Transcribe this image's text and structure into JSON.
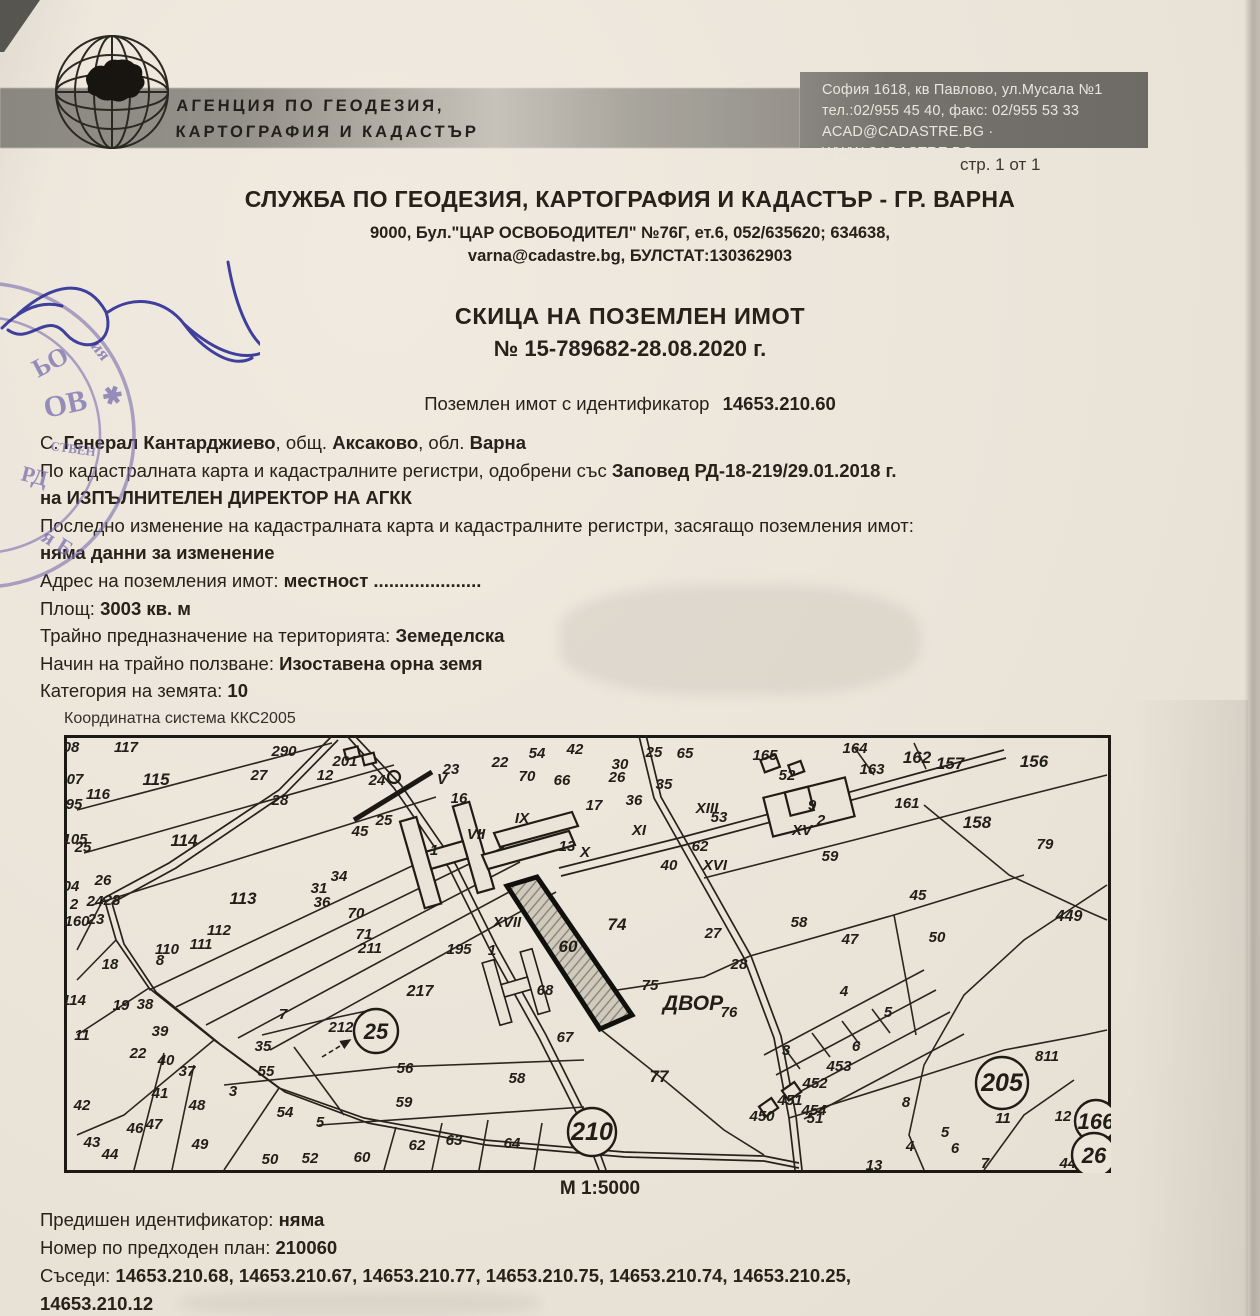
{
  "page": {
    "marker": "стр. 1 от 1"
  },
  "agency": {
    "logo_icon": "globe-bulgaria-icon",
    "name_line1": "АГЕНЦИЯ ПО ГЕОДЕЗИЯ,",
    "name_line2": "КАРТОГРАФИЯ И КАДАСТЪР",
    "address_line1": "София 1618, кв Павлово, ул.Мусала №1",
    "address_line2": "тел.:02/955 45 40, факс: 02/955 53 33",
    "address_line3": "ACAD@CADASTRE.BG · WWW.CADASTRE.BG"
  },
  "office": {
    "title": "СЛУЖБА ПО ГЕОДЕЗИЯ, КАРТОГРАФИЯ И КАДАСТЪР - ГР. ВАРНА",
    "address_line1": "9000, Бул.\"ЦАР ОСВОБОДИТЕЛ\" №76Г, ет.6, 052/635620; 634638,",
    "address_line2": "varna@cadastre.bg, БУЛСТАТ:130362903"
  },
  "document": {
    "title": "СКИЦА НА ПОЗЕМЛЕН ИМОТ",
    "number": "№ 15-789682-28.08.2020 г.",
    "identifier_label": "Поземлен имот с  идентификатор",
    "identifier": "14653.210.60"
  },
  "details": {
    "lines": [
      [
        [
          "С. ",
          0
        ],
        [
          "Генерал Кантарджиево",
          1
        ],
        [
          ", общ. ",
          0
        ],
        [
          "Аксаково",
          1
        ],
        [
          ", обл. ",
          0
        ],
        [
          "Варна",
          1
        ]
      ],
      [
        [
          "По кадастралната карта и кадастралните регистри, одобрени със ",
          0
        ],
        [
          "Заповед РД-18-219/29.01.2018 г.",
          1
        ]
      ],
      [
        [
          "на ИЗПЪЛНИТЕЛЕН ДИРЕКТОР НА АГКК",
          1
        ]
      ],
      [
        [
          "Последно изменение на кадастралната карта и кадастралните регистри, засягащо поземления имот:",
          0
        ]
      ],
      [
        [
          "няма данни за изменение",
          1
        ]
      ],
      [
        [
          "Адрес на поземления имот: ",
          0
        ],
        [
          "местност .....................",
          1
        ]
      ],
      [
        [
          "Площ: ",
          0
        ],
        [
          "3003 кв. м",
          1
        ]
      ],
      [
        [
          "Трайно предназначение на територията: ",
          0
        ],
        [
          "Земеделска",
          1
        ]
      ],
      [
        [
          "Начин на трайно ползване: ",
          0
        ],
        [
          "Изоставена орна земя",
          1
        ]
      ],
      [
        [
          "Категория на земята: ",
          0
        ],
        [
          "10",
          1
        ]
      ]
    ]
  },
  "map": {
    "caption": "Координатна система ККС2005",
    "scale": "М 1:5000",
    "highlight": {
      "label": "60",
      "x": 504,
      "y": 212,
      "size": 17
    },
    "zone_label": {
      "text": "ДВОР",
      "x": 629,
      "y": 268,
      "size": 21
    },
    "circles": [
      {
        "label": "25",
        "x": 312,
        "y": 296,
        "r": 22
      },
      {
        "label": "210",
        "x": 528,
        "y": 397,
        "r": 24
      },
      {
        "label": "205",
        "x": 938,
        "y": 348,
        "r": 26
      },
      {
        "label": "166",
        "x": 1032,
        "y": 386,
        "r": 21
      },
      {
        "label": "26",
        "x": 1030,
        "y": 420,
        "r": 22
      }
    ],
    "labels": [
      [
        "08",
        7,
        12
      ],
      [
        "117",
        62,
        12
      ],
      [
        "07",
        11,
        44
      ],
      [
        "115",
        92,
        45,
        17
      ],
      [
        "116",
        34,
        59
      ],
      [
        "95",
        10,
        69
      ],
      [
        "105",
        11,
        104
      ],
      [
        "25",
        19,
        112
      ],
      [
        "114",
        120,
        106,
        17
      ],
      [
        "26",
        39,
        145
      ],
      [
        "04",
        7,
        151
      ],
      [
        "24",
        31,
        166
      ],
      [
        "28",
        48,
        165
      ],
      [
        "2",
        10,
        169
      ],
      [
        "160",
        13,
        186
      ],
      [
        "23",
        32,
        184
      ],
      [
        "113",
        179,
        164,
        17
      ],
      [
        "112",
        155,
        195
      ],
      [
        "111",
        137,
        209
      ],
      [
        "110",
        103,
        214
      ],
      [
        "18",
        46,
        229
      ],
      [
        "114",
        10,
        265
      ],
      [
        "19",
        57,
        270
      ],
      [
        "38",
        81,
        269
      ],
      [
        "39",
        96,
        296
      ],
      [
        "11",
        18,
        300
      ],
      [
        "22",
        74,
        318
      ],
      [
        "40",
        102,
        325
      ],
      [
        "37",
        123,
        336
      ],
      [
        "41",
        96,
        358
      ],
      [
        "42",
        18,
        370
      ],
      [
        "43",
        28,
        407
      ],
      [
        "44",
        46,
        419
      ],
      [
        "46",
        71,
        393
      ],
      [
        "47",
        90,
        389
      ],
      [
        "48",
        133,
        370
      ],
      [
        "49",
        136,
        409
      ],
      [
        "3",
        169,
        356
      ],
      [
        "35",
        199,
        311
      ],
      [
        "7",
        219,
        279
      ],
      [
        "8",
        96,
        225
      ],
      [
        "50",
        206,
        424
      ],
      [
        "52",
        246,
        423
      ],
      [
        "5",
        256,
        387
      ],
      [
        "54",
        221,
        377
      ],
      [
        "55",
        202,
        336
      ],
      [
        "212",
        277,
        292
      ],
      [
        "217",
        356,
        256,
        16
      ],
      [
        "56",
        341,
        333
      ],
      [
        "59",
        340,
        367
      ],
      [
        "60",
        298,
        422
      ],
      [
        "62",
        353,
        410
      ],
      [
        "63",
        390,
        405
      ],
      [
        "64",
        448,
        408
      ],
      [
        "290",
        220,
        16
      ],
      [
        "27",
        195,
        40
      ],
      [
        "28",
        216,
        65
      ],
      [
        "31",
        255,
        153
      ],
      [
        "36",
        258,
        167
      ],
      [
        "34",
        275,
        141
      ],
      [
        "70",
        292,
        178
      ],
      [
        "71",
        300,
        199
      ],
      [
        "211",
        306,
        213
      ],
      [
        "45",
        296,
        96
      ],
      [
        "25",
        320,
        85
      ],
      [
        "24",
        313,
        45
      ],
      [
        "201",
        281,
        26
      ],
      [
        "12",
        261,
        40
      ],
      [
        "V",
        378,
        44
      ],
      [
        "23",
        387,
        34
      ],
      [
        "22",
        436,
        27
      ],
      [
        "54",
        473,
        18
      ],
      [
        "42",
        511,
        14
      ],
      [
        "70",
        463,
        41
      ],
      [
        "66",
        498,
        45
      ],
      [
        "30",
        556,
        29
      ],
      [
        "26",
        553,
        42
      ],
      [
        "25",
        590,
        17
      ],
      [
        "35",
        600,
        49
      ],
      [
        "36",
        570,
        65
      ],
      [
        "65",
        621,
        18
      ],
      [
        "16",
        395,
        63
      ],
      [
        "VII",
        412,
        99
      ],
      [
        "1",
        370,
        115
      ],
      [
        "IX",
        458,
        83
      ],
      [
        "17",
        530,
        70
      ],
      [
        "13",
        503,
        111
      ],
      [
        "X",
        521,
        117
      ],
      [
        "XI",
        575,
        95
      ],
      [
        "XIII",
        643,
        73
      ],
      [
        "53",
        655,
        82
      ],
      [
        "62",
        636,
        111
      ],
      [
        "XVI",
        651,
        130
      ],
      [
        "40",
        605,
        130
      ],
      [
        "74",
        553,
        190,
        17
      ],
      [
        "27",
        649,
        198
      ],
      [
        "XVII",
        443,
        187
      ],
      [
        "195",
        395,
        214
      ],
      [
        "1",
        428,
        215
      ],
      [
        "68",
        481,
        255
      ],
      [
        "67",
        501,
        302
      ],
      [
        "58",
        453,
        343
      ],
      [
        "75",
        586,
        250
      ],
      [
        "76",
        665,
        277
      ],
      [
        "77",
        595,
        342,
        17
      ],
      [
        "3",
        722,
        315
      ],
      [
        "28",
        675,
        229
      ],
      [
        "165",
        701,
        20
      ],
      [
        "164",
        791,
        13
      ],
      [
        "163",
        808,
        34
      ],
      [
        "162",
        853,
        23,
        17
      ],
      [
        "157",
        886,
        29,
        17
      ],
      [
        "156",
        970,
        27,
        17
      ],
      [
        "161",
        843,
        68
      ],
      [
        "158",
        913,
        88,
        17
      ],
      [
        "52",
        723,
        40
      ],
      [
        "9",
        748,
        70
      ],
      [
        "2",
        757,
        85
      ],
      [
        "XV",
        738,
        95
      ],
      [
        "59",
        766,
        121
      ],
      [
        "79",
        981,
        109
      ],
      [
        "449",
        1005,
        181,
        16
      ],
      [
        "45",
        854,
        160
      ],
      [
        "58",
        735,
        187
      ],
      [
        "47",
        786,
        204
      ],
      [
        "50",
        873,
        202
      ],
      [
        "4",
        780,
        256
      ],
      [
        "5",
        824,
        277
      ],
      [
        "6",
        792,
        311
      ],
      [
        "453",
        775,
        331
      ],
      [
        "452",
        751,
        348
      ],
      [
        "451",
        726,
        365
      ],
      [
        "454",
        750,
        375
      ],
      [
        "51",
        751,
        383
      ],
      [
        "8",
        842,
        367
      ],
      [
        "13",
        810,
        430
      ],
      [
        "4",
        846,
        411
      ],
      [
        "5",
        881,
        397
      ],
      [
        "6",
        891,
        413
      ],
      [
        "7",
        921,
        428
      ],
      [
        "811",
        983,
        321
      ],
      [
        "11",
        939,
        383
      ],
      [
        "12",
        999,
        381
      ],
      [
        "812",
        1030,
        376
      ],
      [
        "441",
        1008,
        428
      ],
      [
        "450",
        698,
        381
      ]
    ]
  },
  "footer": {
    "previous_id_label": "Предишен идентификатор: ",
    "previous_id": "няма",
    "plan_number_label": "Номер по предходен план: ",
    "plan_number": "210060",
    "neighbors_label": "Съседи: ",
    "neighbors_line1": "14653.210.68, 14653.210.67, 14653.210.77, 14653.210.75, 14653.210.74, 14653.210.25,",
    "neighbors_line2": "14653.210.12"
  }
}
